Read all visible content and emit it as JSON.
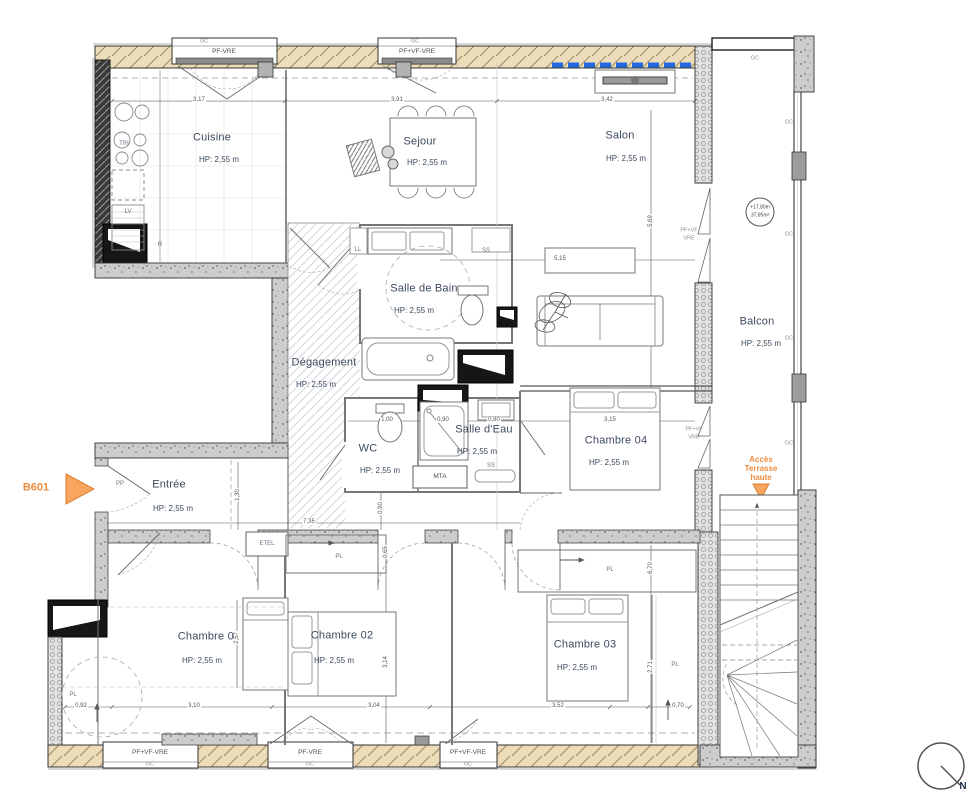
{
  "plan": {
    "unit": "B601",
    "north_label": "N",
    "level_marker": {
      "altitude": "+17,80m",
      "area": "37,85m²"
    },
    "access_label": {
      "line1": "Accès",
      "line2": "Terrasse",
      "line3": "haute"
    },
    "rooms": [
      {
        "name": "Cuisine",
        "hp": "HP: 2,55 m"
      },
      {
        "name": "Sejour",
        "hp": "HP: 2,55 m"
      },
      {
        "name": "Salon",
        "hp": "HP: 2,55 m"
      },
      {
        "name": "Salle de Bain",
        "hp": "HP: 2,55 m"
      },
      {
        "name": "Dégagement",
        "hp": "HP: 2,55 m"
      },
      {
        "name": "WC",
        "hp": "HP: 2,55 m"
      },
      {
        "name": "Salle d'Eau",
        "hp": "HP: 2,55 m"
      },
      {
        "name": "Chambre 04",
        "hp": "HP: 2,55 m"
      },
      {
        "name": "Entrée",
        "hp": "HP: 2,55 m"
      },
      {
        "name": "Chambre 01",
        "hp": "HP: 2,55 m"
      },
      {
        "name": "Chambre 02",
        "hp": "HP: 2,55 m"
      },
      {
        "name": "Chambre 03",
        "hp": "HP: 2,55 m"
      },
      {
        "name": "Balcon",
        "hp": "HP: 2,55 m"
      }
    ],
    "labels": {
      "gc": "GC",
      "pl": "PL",
      "ss": "SS",
      "ll": "LL",
      "lv": "LV",
      "tri": "TRI",
      "r": "R",
      "mta": "MTA",
      "etel": "ETEL",
      "pp": "PP",
      "pf_vre": "PF-VRE",
      "pf_vf_vre": "PF+VF-VRE",
      "pf_vf": "PF+VF",
      "vre": "VRE"
    },
    "dimensions": {
      "top": [
        "3,17",
        "3,91",
        "3,42"
      ],
      "bottom": [
        "0,92",
        "3,10",
        "3,04",
        "3,52",
        "0,70"
      ],
      "interior": [
        "5,15",
        "3,15",
        "7,35",
        "1,00",
        "0,90",
        "0,80"
      ],
      "vertical": [
        "5,69",
        "1,30",
        "0,90",
        "0,65",
        "3,14",
        "2,57",
        "6,70",
        "2,71"
      ]
    },
    "colors": {
      "accent_orange": "#EF8C3E",
      "window_blue": "#2468E0",
      "text": "#3C4A5C"
    }
  }
}
